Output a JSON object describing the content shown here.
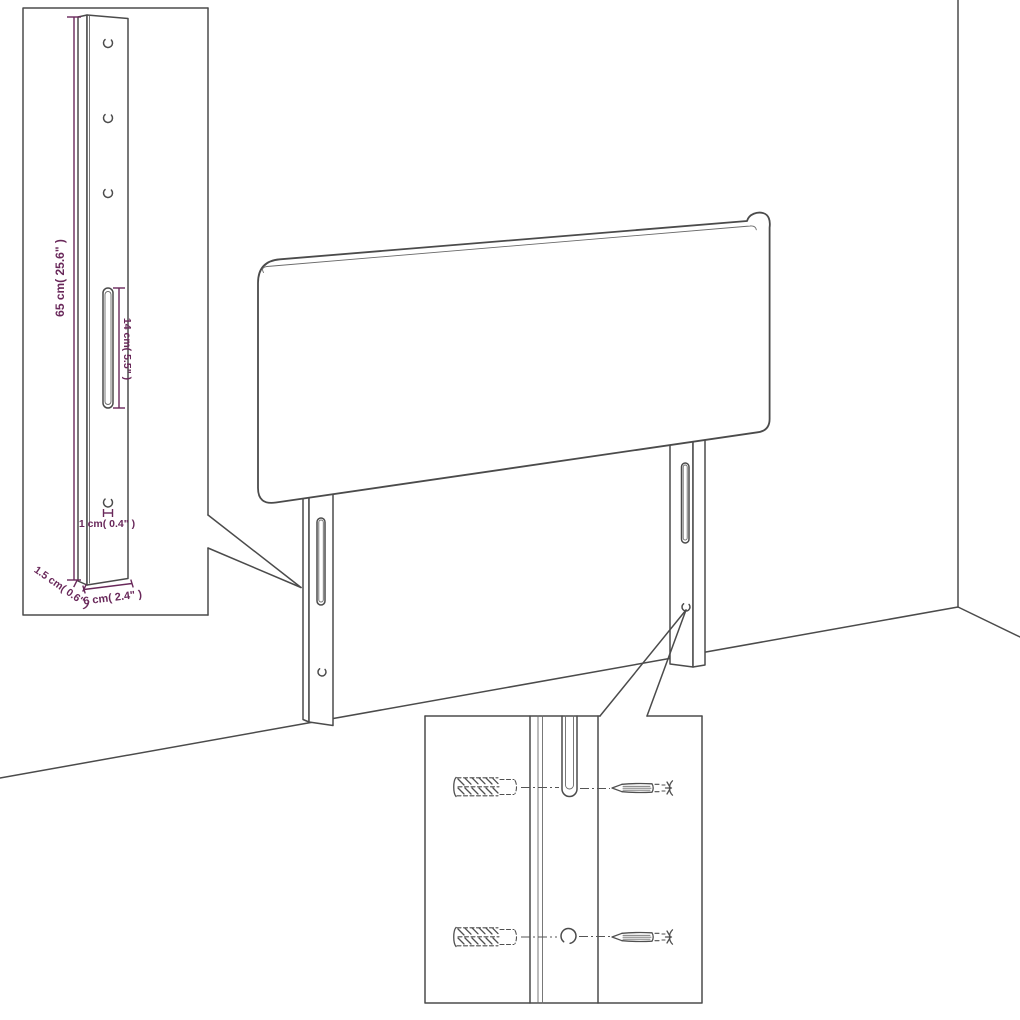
{
  "diagram": {
    "kind": "headboard-assembly-line-drawing",
    "colors": {
      "line": "#4b4b4b",
      "dimension": "#69285a",
      "background": "#ffffff"
    },
    "scene": {
      "items": [
        "headboard-panel",
        "left-mounting-leg",
        "right-mounting-leg",
        "wall-corner",
        "floor-line"
      ]
    },
    "leg_inset": {
      "height_label": "65 cm( 25.6\" )",
      "slot_label": "14 cm( 5.5\" )",
      "hole_label": "1 cm( 0.4\" )",
      "depth_label": "1.5 cm( 0.6\" )",
      "width_label": "6 cm( 2.4\" )",
      "hole_count": 4
    },
    "hardware_inset": {
      "wall_plug_icon": "wall-plug-icon",
      "screw_icon": "screw-icon",
      "wall_plug_count": 2,
      "screw_count": 2
    }
  }
}
